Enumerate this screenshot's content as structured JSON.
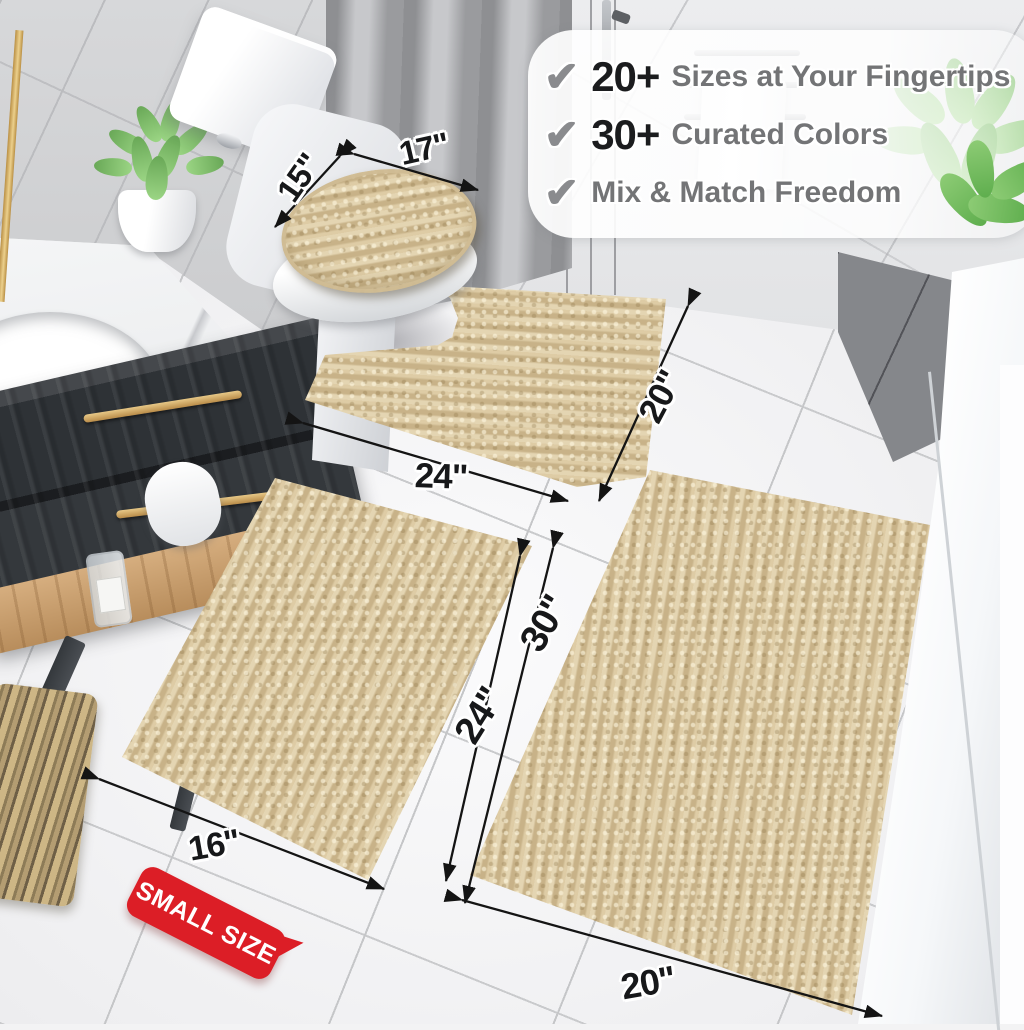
{
  "callout": {
    "items": [
      {
        "icon": "check-icon",
        "stat": "20+",
        "label": "Sizes at Your Fingertips"
      },
      {
        "icon": "check-icon",
        "stat": "30+",
        "label": "Curated Colors"
      },
      {
        "icon": "check-icon",
        "stat": "",
        "label": "Mix & Match Freedom"
      }
    ]
  },
  "badge": {
    "label": "SMALL SIZE"
  },
  "dimensions": {
    "lid_width": "17\"",
    "lid_depth": "15\"",
    "contour_width": "24\"",
    "contour_depth": "20\"",
    "small_rug_length": "24\"",
    "small_rug_width": "16\"",
    "large_rug_length": "30\"",
    "large_rug_width": "20\""
  },
  "colors": {
    "rug_beige": "#d9c59c",
    "badge_red": "#dc1e26",
    "dimension_text": "#17181a",
    "callout_stat": "#1b1c1e",
    "callout_label": "#737476",
    "check_gray": "#8a8b8e"
  }
}
